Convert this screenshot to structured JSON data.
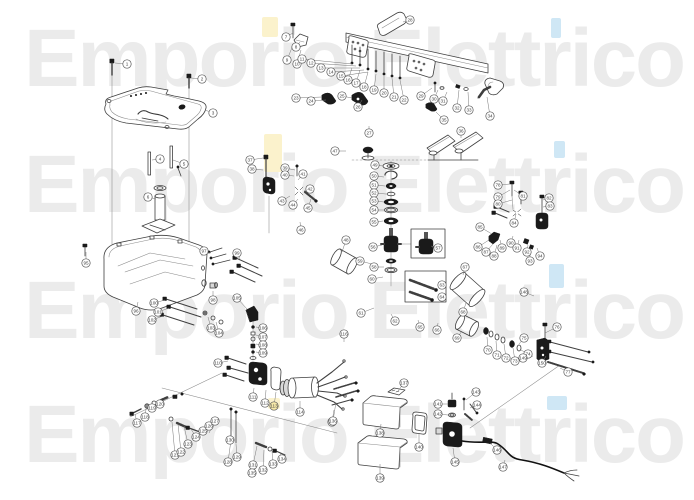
{
  "watermark": {
    "text": "Emporio Elettrico",
    "color": "#ebebeb",
    "highlight_yellow": "#fbf2cc",
    "highlight_blue": "#cfe7f5",
    "highlights": [
      {
        "x": 262,
        "y": 17,
        "w": 16,
        "h": 20,
        "c": "#fbf2cc"
      },
      {
        "x": 264,
        "y": 134,
        "w": 18,
        "h": 38,
        "c": "#fbf2cc"
      },
      {
        "x": 268,
        "y": 398,
        "w": 12,
        "h": 11,
        "c": "#fbf2cc"
      },
      {
        "x": 551,
        "y": 18,
        "w": 10,
        "h": 20,
        "c": "#cfe7f5"
      },
      {
        "x": 554,
        "y": 141,
        "w": 11,
        "h": 17,
        "c": "#cfe7f5"
      },
      {
        "x": 549,
        "y": 264,
        "w": 15,
        "h": 24,
        "c": "#cfe7f5"
      },
      {
        "x": 547,
        "y": 396,
        "w": 20,
        "h": 14,
        "c": "#cfe7f5"
      }
    ]
  },
  "diagram": {
    "line_color": "#3f3f3f",
    "dark_fill": "#1a1a1a",
    "background": "#ffffff",
    "callout_radius": 4.2,
    "callouts": [
      {
        "x": 127,
        "y": 64,
        "l": [
          115,
          63
        ]
      },
      {
        "x": 202,
        "y": 79,
        "l": [
          191,
          78
        ]
      },
      {
        "x": 213,
        "y": 113,
        "l": [
          205,
          110
        ]
      },
      {
        "x": 160,
        "y": 159,
        "l": [
          152,
          160
        ]
      },
      {
        "x": 184,
        "y": 164,
        "l": [
          173,
          160
        ]
      },
      {
        "x": 148,
        "y": 197,
        "l": [
          156,
          199
        ]
      },
      {
        "x": 286,
        "y": 37,
        "l": [
          293,
          33
        ]
      },
      {
        "x": 296,
        "y": 47,
        "l": [
          300,
          42
        ]
      },
      {
        "x": 287,
        "y": 60,
        "l": [
          293,
          45
        ]
      },
      {
        "x": 297,
        "y": 64,
        "l": [
          301,
          50
        ]
      },
      {
        "x": 302,
        "y": 59,
        "l": [
          352,
          64
        ]
      },
      {
        "x": 311,
        "y": 63,
        "l": [
          356,
          66
        ]
      },
      {
        "x": 321,
        "y": 68,
        "l": [
          360,
          68
        ]
      },
      {
        "x": 331,
        "y": 72,
        "l": [
          364,
          70
        ]
      },
      {
        "x": 341,
        "y": 76,
        "l": [
          368,
          72
        ]
      },
      {
        "x": 348,
        "y": 80,
        "l": [
          352,
          68
        ]
      },
      {
        "x": 356,
        "y": 83,
        "l": [
          360,
          70
        ]
      },
      {
        "x": 364,
        "y": 87,
        "l": [
          368,
          72
        ]
      },
      {
        "x": 374,
        "y": 90,
        "l": [
          376,
          74
        ]
      },
      {
        "x": 384,
        "y": 93,
        "l": [
          384,
          76
        ]
      },
      {
        "x": 394,
        "y": 97,
        "l": [
          392,
          78
        ]
      },
      {
        "x": 404,
        "y": 100,
        "l": [
          400,
          80
        ]
      },
      {
        "x": 296,
        "y": 98,
        "l": [
          322,
          97
        ]
      },
      {
        "x": 311,
        "y": 101,
        "l": [
          326,
          100
        ]
      },
      {
        "x": 342,
        "y": 96,
        "l": [
          352,
          98
        ]
      },
      {
        "x": 358,
        "y": 107,
        "l": [
          362,
          100
        ]
      },
      {
        "x": 369,
        "y": 133,
        "l": [
          369,
          126
        ]
      },
      {
        "x": 410,
        "y": 20,
        "l": [
          403,
          22
        ]
      },
      {
        "x": 421,
        "y": 96,
        "l": [
          432,
          88
        ]
      },
      {
        "x": 434,
        "y": 99,
        "l": [
          438,
          90
        ]
      },
      {
        "x": 443,
        "y": 101,
        "l": [
          447,
          92
        ]
      },
      {
        "x": 457,
        "y": 108,
        "l": [
          459,
          90
        ]
      },
      {
        "x": 469,
        "y": 110,
        "l": [
          468,
          92
        ]
      },
      {
        "x": 490,
        "y": 116,
        "l": [
          487,
          97
        ]
      },
      {
        "x": 444,
        "y": 120,
        "l": [
          436,
          112
        ]
      },
      {
        "x": 461,
        "y": 131,
        "l": [
          461,
          138
        ]
      },
      {
        "x": 250,
        "y": 160,
        "l": [
          263,
          158
        ]
      },
      {
        "x": 252,
        "y": 169,
        "l": [
          263,
          170
        ]
      },
      {
        "x": 285,
        "y": 168,
        "l": [
          295,
          170
        ]
      },
      {
        "x": 285,
        "y": 175,
        "l": [
          294,
          176
        ]
      },
      {
        "x": 303,
        "y": 174,
        "l": [
          298,
          180
        ]
      },
      {
        "x": 310,
        "y": 189,
        "l": [
          304,
          191
        ]
      },
      {
        "x": 282,
        "y": 201,
        "l": [
          290,
          196
        ]
      },
      {
        "x": 293,
        "y": 205,
        "l": [
          298,
          199
        ]
      },
      {
        "x": 308,
        "y": 208,
        "l": [
          311,
          199
        ]
      },
      {
        "x": 301,
        "y": 230,
        "l": [
          300,
          222
        ]
      },
      {
        "x": 335,
        "y": 151,
        "l": [
          346,
          151
        ]
      },
      {
        "x": 346,
        "y": 240,
        "l": [
          342,
          252
        ]
      },
      {
        "x": 375,
        "y": 165,
        "l": [
          383,
          166
        ]
      },
      {
        "x": 374,
        "y": 176,
        "l": [
          384,
          177
        ]
      },
      {
        "x": 374,
        "y": 185,
        "l": [
          385,
          186
        ]
      },
      {
        "x": 374,
        "y": 193,
        "l": [
          386,
          194
        ]
      },
      {
        "x": 374,
        "y": 201,
        "l": [
          384,
          202
        ]
      },
      {
        "x": 374,
        "y": 210,
        "l": [
          384,
          210
        ]
      },
      {
        "x": 374,
        "y": 222,
        "l": [
          383,
          221
        ]
      },
      {
        "x": 373,
        "y": 247,
        "l": [
          382,
          245
        ]
      },
      {
        "x": 438,
        "y": 248,
        "l": [
          431,
          246
        ]
      },
      {
        "x": 374,
        "y": 267,
        "l": [
          384,
          267
        ]
      },
      {
        "x": 360,
        "y": 261,
        "l": [
          372,
          264
        ]
      },
      {
        "x": 372,
        "y": 279,
        "l": [
          383,
          277
        ]
      },
      {
        "x": 361,
        "y": 313,
        "l": [
          374,
          308
        ]
      },
      {
        "x": 395,
        "y": 321,
        "l": [
          391,
          314
        ]
      },
      {
        "x": 442,
        "y": 285
      },
      {
        "x": 442,
        "y": 297
      },
      {
        "x": 420,
        "y": 327,
        "l": [
          418,
          320
        ]
      },
      {
        "x": 437,
        "y": 330,
        "l": [
          438,
          323
        ]
      },
      {
        "x": 465,
        "y": 267,
        "l": [
          463,
          275
        ]
      },
      {
        "x": 463,
        "y": 312,
        "l": [
          466,
          303
        ]
      },
      {
        "x": 457,
        "y": 338,
        "l": [
          462,
          331
        ]
      },
      {
        "x": 488,
        "y": 350,
        "l": [
          487,
          337
        ]
      },
      {
        "x": 497,
        "y": 355,
        "l": [
          496,
          341
        ]
      },
      {
        "x": 506,
        "y": 358,
        "l": [
          504,
          344
        ]
      },
      {
        "x": 515,
        "y": 361,
        "l": [
          513,
          348
        ]
      },
      {
        "x": 528,
        "y": 354,
        "l": [
          521,
          350
        ]
      },
      {
        "x": 524,
        "y": 338,
        "l": [
          519,
          344
        ]
      },
      {
        "x": 557,
        "y": 327,
        "l": [
          545,
          333
        ]
      },
      {
        "x": 568,
        "y": 372,
        "l": [
          560,
          368
        ]
      },
      {
        "x": 498,
        "y": 185,
        "l": [
          510,
          184
        ]
      },
      {
        "x": 498,
        "y": 197,
        "l": [
          510,
          190
        ]
      },
      {
        "x": 498,
        "y": 204,
        "l": [
          512,
          200
        ]
      },
      {
        "x": 523,
        "y": 196,
        "l": [
          514,
          190
        ]
      },
      {
        "x": 549,
        "y": 198,
        "l": [
          543,
          200
        ]
      },
      {
        "x": 550,
        "y": 206,
        "l": [
          543,
          207
        ]
      },
      {
        "x": 514,
        "y": 223,
        "l": [
          516,
          214
        ]
      },
      {
        "x": 480,
        "y": 227,
        "l": [
          492,
          234
        ]
      },
      {
        "x": 478,
        "y": 247,
        "l": [
          489,
          240
        ]
      },
      {
        "x": 486,
        "y": 252,
        "l": [
          493,
          244
        ]
      },
      {
        "x": 494,
        "y": 256,
        "l": [
          497,
          245
        ]
      },
      {
        "x": 502,
        "y": 248,
        "l": [
          500,
          240
        ]
      },
      {
        "x": 511,
        "y": 243,
        "l": [
          513,
          236
        ]
      },
      {
        "x": 517,
        "y": 248,
        "l": [
          519,
          240
        ]
      },
      {
        "x": 527,
        "y": 252,
        "l": [
          528,
          245
        ]
      },
      {
        "x": 530,
        "y": 261,
        "l": [
          530,
          252
        ]
      },
      {
        "x": 540,
        "y": 256,
        "l": [
          537,
          248
        ]
      },
      {
        "x": 86,
        "y": 263,
        "l": [
          86,
          252
        ]
      },
      {
        "x": 136,
        "y": 311,
        "l": [
          138,
          302
        ]
      },
      {
        "x": 204,
        "y": 251,
        "l": [
          211,
          253
        ]
      },
      {
        "x": 213,
        "y": 300,
        "l": [
          213,
          291
        ]
      },
      {
        "x": 237,
        "y": 253,
        "l": [
          240,
          259
        ]
      },
      {
        "x": 154,
        "y": 303,
        "l": [
          165,
          300
        ]
      },
      {
        "x": 158,
        "y": 312,
        "l": [
          169,
          308
        ]
      },
      {
        "x": 152,
        "y": 320,
        "l": [
          163,
          316
        ]
      },
      {
        "x": 211,
        "y": 328,
        "l": [
          208,
          317
        ]
      },
      {
        "x": 219,
        "y": 333,
        "l": [
          216,
          322
        ]
      },
      {
        "x": 237,
        "y": 298,
        "l": [
          247,
          309
        ]
      },
      {
        "x": 263,
        "y": 328,
        "l": [
          256,
          327
        ]
      },
      {
        "x": 263,
        "y": 337,
        "l": [
          256,
          335
        ]
      },
      {
        "x": 263,
        "y": 345,
        "l": [
          256,
          344
        ]
      },
      {
        "x": 263,
        "y": 353,
        "l": [
          256,
          352
        ]
      },
      {
        "x": 218,
        "y": 363,
        "l": [
          228,
          361
        ]
      },
      {
        "x": 253,
        "y": 397,
        "l": [
          254,
          388
        ]
      },
      {
        "x": 265,
        "y": 403,
        "l": [
          266,
          390
        ]
      },
      {
        "x": 274,
        "y": 406,
        "hl": "#f6e9a8",
        "l": [
          276,
          392
        ]
      },
      {
        "x": 300,
        "y": 412,
        "l": [
          300,
          401
        ]
      },
      {
        "x": 332,
        "y": 422,
        "l": [
          334,
          410
        ]
      },
      {
        "x": 344,
        "y": 334,
        "l": [
          344,
          342
        ]
      },
      {
        "x": 137,
        "y": 423,
        "l": [
          135,
          414
        ]
      },
      {
        "x": 145,
        "y": 417,
        "l": [
          146,
          409
        ]
      },
      {
        "x": 152,
        "y": 408,
        "l": [
          153,
          404
        ]
      },
      {
        "x": 160,
        "y": 404,
        "l": [
          161,
          400
        ]
      },
      {
        "x": 175,
        "y": 455,
        "l": [
          172,
          422
        ]
      },
      {
        "x": 181,
        "y": 452,
        "l": [
          178,
          424
        ]
      },
      {
        "x": 188,
        "y": 444,
        "l": [
          184,
          426
        ]
      },
      {
        "x": 196,
        "y": 437,
        "l": [
          191,
          429
        ]
      },
      {
        "x": 203,
        "y": 431,
        "l": [
          198,
          431
        ]
      },
      {
        "x": 209,
        "y": 426,
        "l": [
          204,
          432
        ]
      },
      {
        "x": 215,
        "y": 421,
        "l": [
          209,
          433
        ]
      },
      {
        "x": 228,
        "y": 462,
        "l": [
          231,
          440
        ]
      },
      {
        "x": 237,
        "y": 457,
        "l": [
          236,
          444
        ]
      },
      {
        "x": 230,
        "y": 440,
        "l": [
          231,
          436
        ]
      },
      {
        "x": 253,
        "y": 465,
        "l": [
          257,
          446
        ]
      },
      {
        "x": 263,
        "y": 470,
        "l": [
          264,
          450
        ]
      },
      {
        "x": 273,
        "y": 464,
        "l": [
          272,
          451
        ]
      },
      {
        "x": 282,
        "y": 459,
        "l": [
          280,
          453
        ]
      },
      {
        "x": 252,
        "y": 473,
        "l": [
          252,
          466
        ]
      },
      {
        "x": 333,
        "y": 421,
        "l": [
          336,
          402
        ]
      },
      {
        "x": 404,
        "y": 383,
        "l": [
          398,
          391
        ]
      },
      {
        "x": 380,
        "y": 433,
        "l": [
          381,
          424
        ]
      },
      {
        "x": 380,
        "y": 478,
        "l": [
          380,
          464
        ]
      },
      {
        "x": 419,
        "y": 447,
        "l": [
          419,
          434
        ]
      },
      {
        "x": 438,
        "y": 404,
        "l": [
          448,
          404
        ]
      },
      {
        "x": 438,
        "y": 414,
        "l": [
          448,
          415
        ]
      },
      {
        "x": 476,
        "y": 392,
        "l": [
          466,
          400
        ]
      },
      {
        "x": 477,
        "y": 405,
        "l": [
          470,
          408
        ]
      },
      {
        "x": 455,
        "y": 462,
        "l": [
          453,
          448
        ]
      },
      {
        "x": 497,
        "y": 450,
        "l": [
          490,
          443
        ]
      },
      {
        "x": 503,
        "y": 467,
        "l": [
          505,
          460
        ]
      },
      {
        "x": 524,
        "y": 292,
        "l": [
          534,
          296
        ]
      },
      {
        "x": 523,
        "y": 358,
        "l": [
          533,
          356
        ]
      },
      {
        "x": 542,
        "y": 363,
        "l": [
          546,
          356
        ]
      }
    ]
  }
}
